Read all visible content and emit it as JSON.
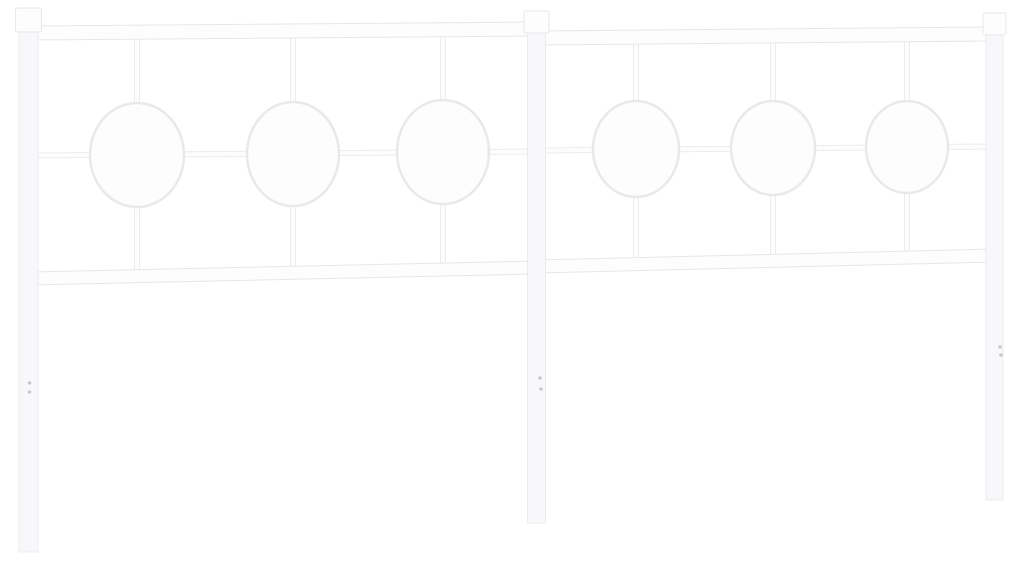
{
  "meta": {
    "type": "product-photo",
    "subject": "White metal bed headboard with circle ornaments on a plain white background"
  },
  "colors": {
    "bg": "#ffffff",
    "metal": "#fdfdfe",
    "metal_soft": "#f8f8fa",
    "edge": "#e7e7ea",
    "edge_soft": "#ececef",
    "ring_edge": "#e9e9ec",
    "hole": "#a6a6ad"
  },
  "structure": {
    "panels": 2,
    "posts": 3,
    "finial_caps": 3,
    "rings_total": 6,
    "rings_per_panel": 3,
    "screw_holes_per_leg": 2
  }
}
